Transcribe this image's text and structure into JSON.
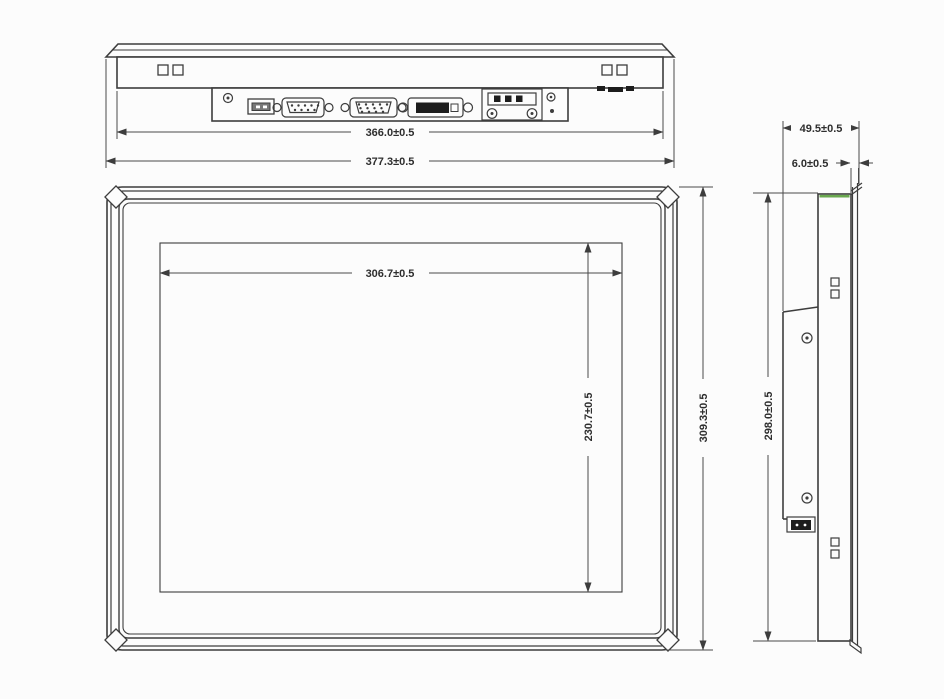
{
  "views": {
    "top_view": {
      "description": "bottom-edge view with I/O ports",
      "dimensions": [
        "366.0±0.5",
        "377.3±0.5"
      ],
      "ports": [
        "mounting-screw",
        "usb-port",
        "serial-db9-port",
        "vga-port",
        "dvi-port",
        "power-terminal-block",
        "led-indicators"
      ]
    },
    "front_view": {
      "description": "front view of panel PC",
      "dimensions": [
        "306.7±0.5",
        "230.7±0.5",
        "309.3±0.5"
      ]
    },
    "side_view": {
      "description": "side profile view",
      "dimensions": [
        "49.5±0.5",
        "6.0±0.5",
        "298.0±0.5"
      ]
    }
  },
  "colors": {
    "background": "#fcfcfc",
    "line": "#3d3d3d",
    "dim_line": "#4a4a4a",
    "accent_green": "#6aa84f",
    "connector_dark": "#1d1d1d"
  }
}
